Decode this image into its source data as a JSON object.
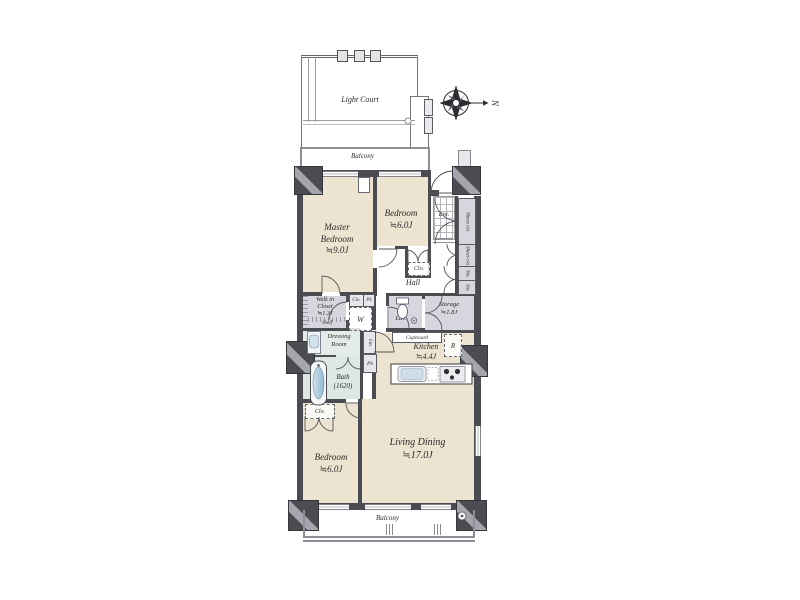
{
  "plan": {
    "light_court": "Light Court",
    "balcony_top": "Balcony",
    "balcony_bottom": "Balcony",
    "compass_north": "N",
    "rooms": {
      "master_bedroom": [
        "Master",
        "Bedroom",
        "≒9.0J"
      ],
      "bedroom_top": [
        "Bedroom",
        "≒6.0J"
      ],
      "bedroom_bottom": [
        "Bedroom",
        "≒6.0J"
      ],
      "living_dining": [
        "Living Dining",
        "≒17.0J"
      ],
      "kitchen": [
        "Kitchen",
        "≒4.4J"
      ],
      "storage": [
        "Storage",
        "≒1.8J"
      ],
      "walk_in_closet": [
        "Walk in",
        "Closet",
        "≒1.3J"
      ],
      "shelf": "Shelf",
      "dressing_room": [
        "Dressing",
        "Room"
      ],
      "bath": [
        "Bath",
        "(1620)"
      ],
      "hall": "Hall",
      "entrance": "Ent.",
      "lavatory": "Lav."
    },
    "fixtures": {
      "cupboard": "Cupboard",
      "shoes_closet_upper": "Shoes clo.",
      "shoes_closet_lower": "Shoes clo.",
      "sto_upper": "Sto.",
      "sto_lower": "Sto.",
      "closet_bedroom_top": "Clo.",
      "closet_bedroom_bottom": "Clo.",
      "closet_hall": "Clo.",
      "ps_hall": "PS",
      "ps_bath": "PS",
      "linen": "Lin.",
      "washer": "W",
      "refrigerator": "R"
    },
    "colors": {
      "floor": "#ece4d0",
      "wet_area": "#dde8e2",
      "dressing_area": "#e3ece8",
      "storage_area": "#d6d7de",
      "wall": "#4b4c52",
      "fixture_accent": "#bdd6e4"
    }
  }
}
